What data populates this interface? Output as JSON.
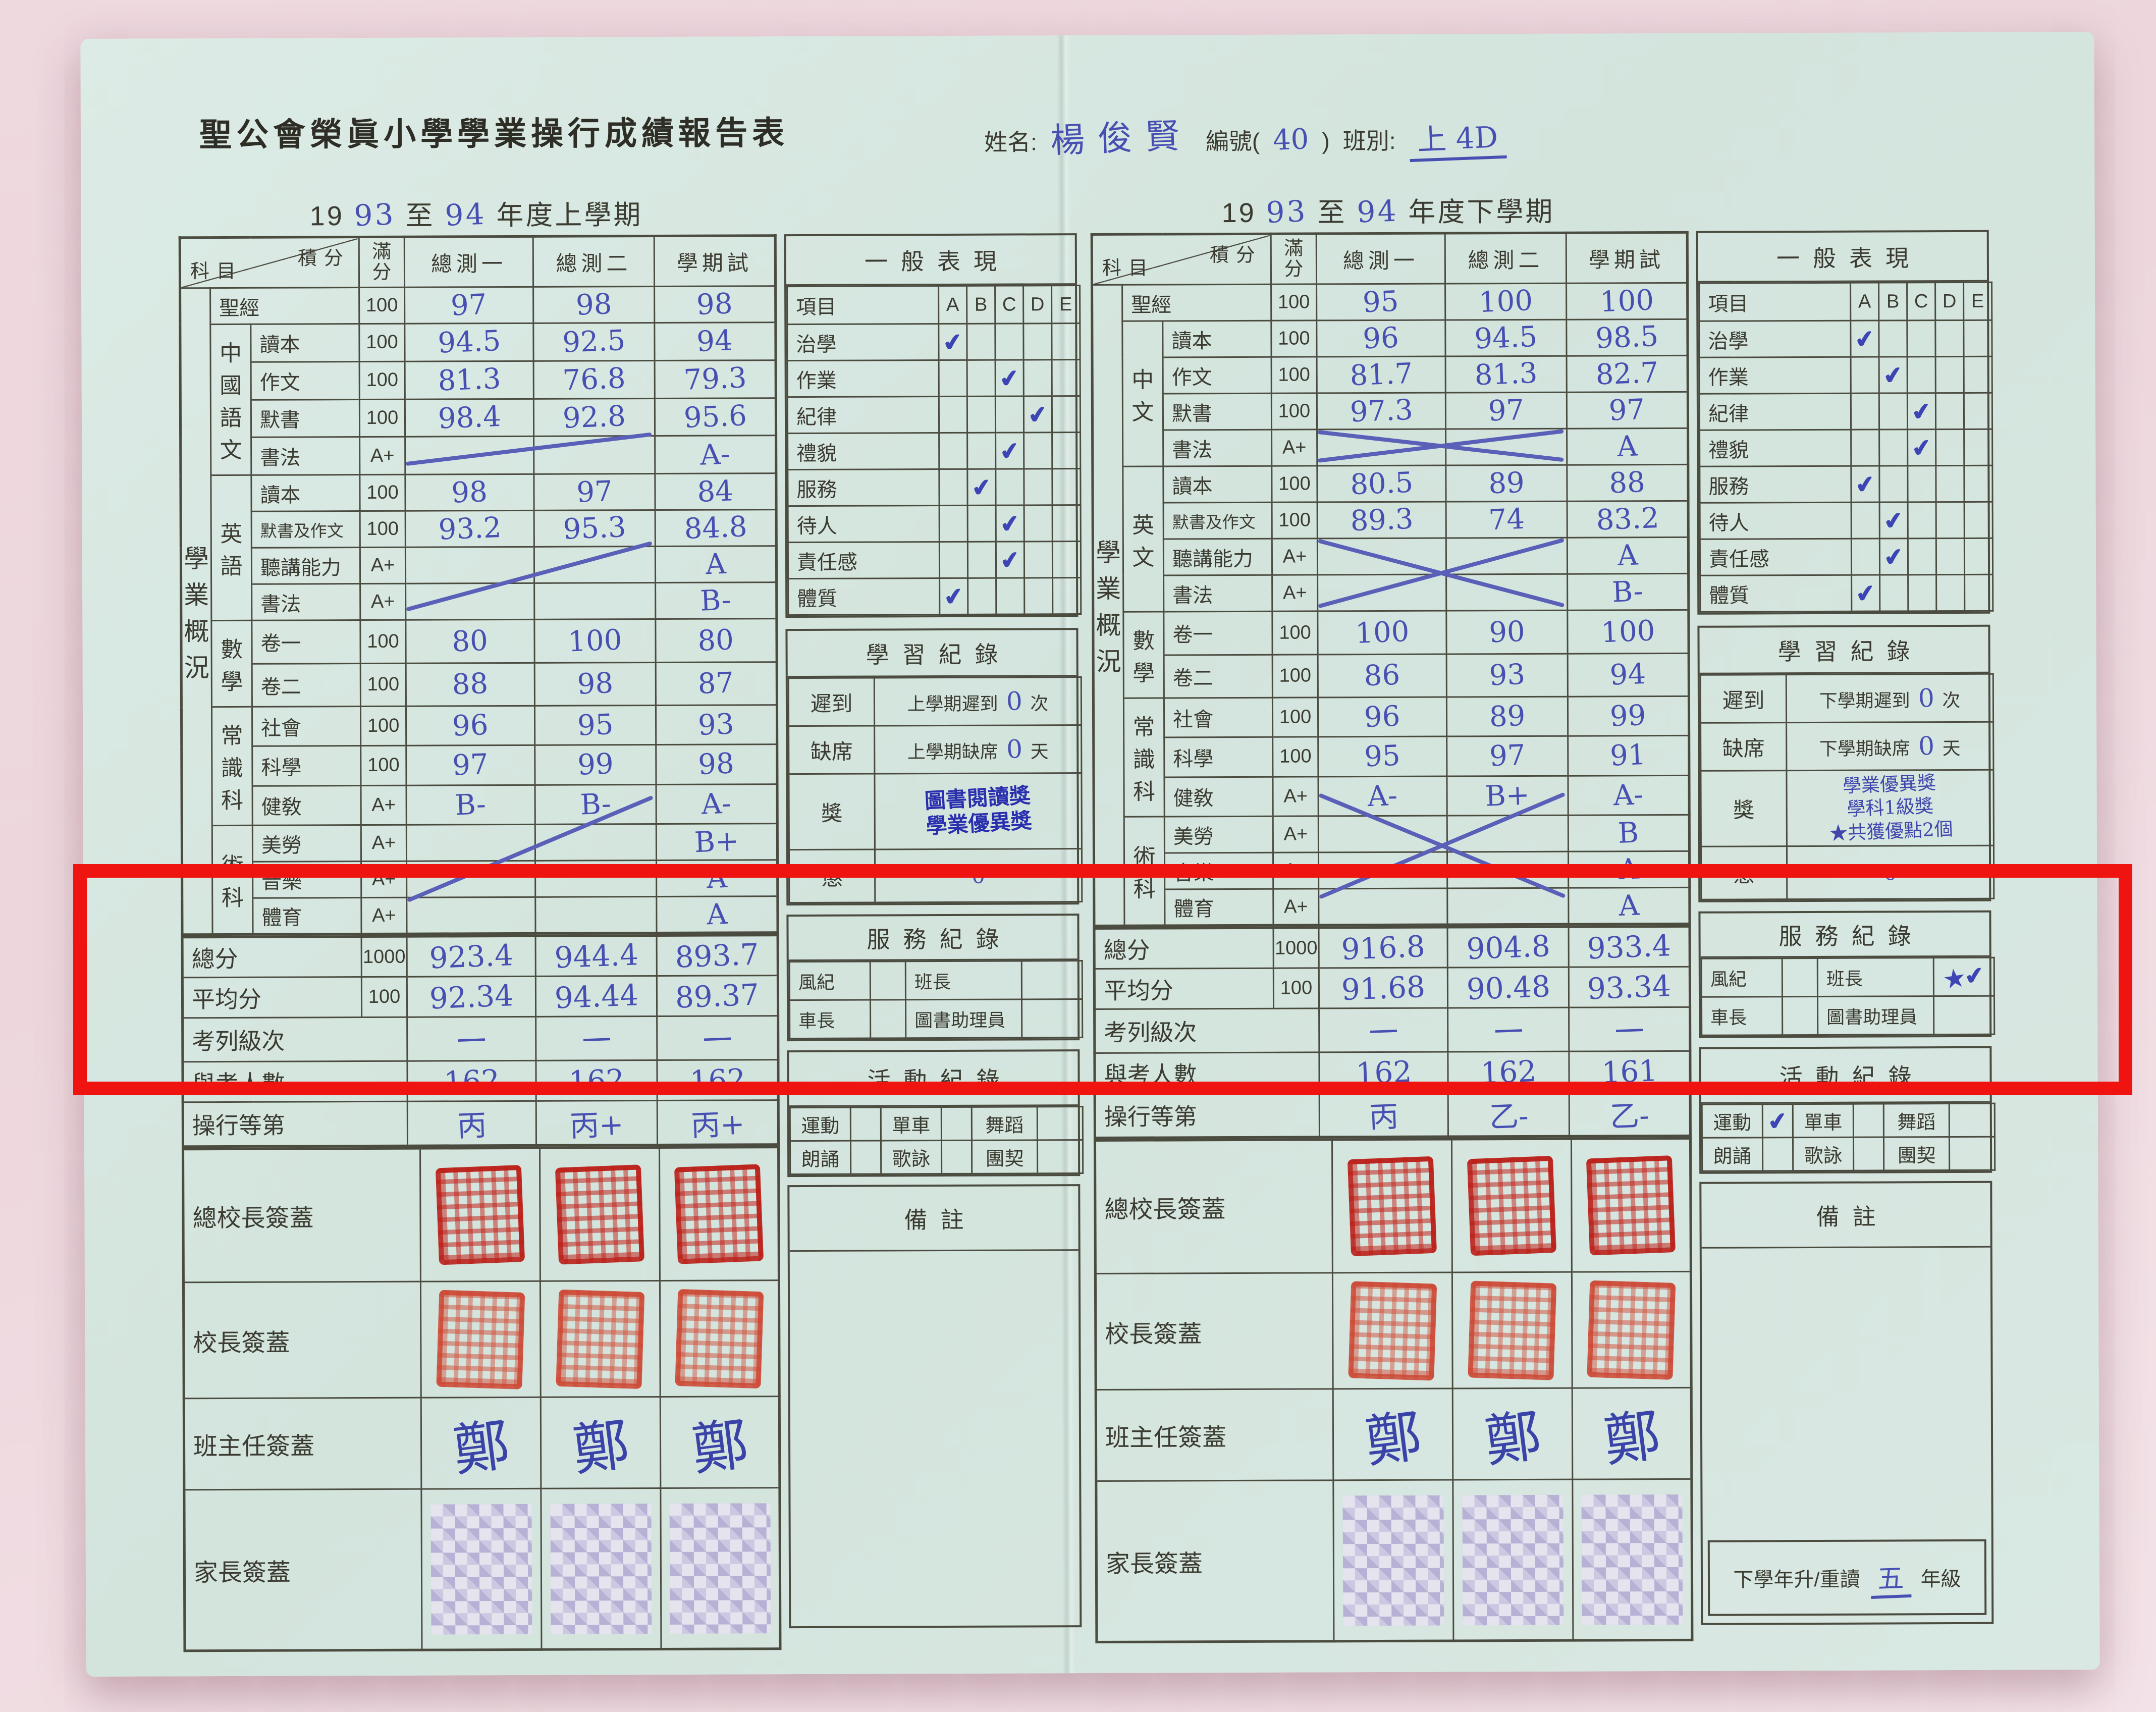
{
  "header": {
    "title": "聖公會榮眞小學學業操行成績報告表",
    "name_label": "姓名:",
    "name_value": "楊俊賢",
    "id_prefix": "編號(",
    "id_value": "40",
    "id_suffix": ")",
    "class_label": "班別:",
    "class_value": "上 4D"
  },
  "columns": {
    "subject": "科目",
    "score": "積分",
    "full": "滿分",
    "t1": "總測一",
    "t2": "總測二",
    "exam": "學期試"
  },
  "side_label": "學業概況",
  "signature_labels": [
    "總校長簽蓋",
    "校長簽蓋",
    "班主任簽蓋",
    "家長簽蓋"
  ],
  "semesters": [
    {
      "year": {
        "prefix": "19",
        "from": "93",
        "mid": "至",
        "to": "94",
        "suffix": "年度上學期"
      },
      "rows": [
        {
          "subject": "聖經",
          "full": "100",
          "t1": "97",
          "t2": "98",
          "exam": "98"
        },
        {
          "group": "中國語文",
          "gspan": 4,
          "subject": "讀本",
          "full": "100",
          "t1": "94.5",
          "t2": "92.5",
          "exam": "94"
        },
        {
          "subject": "作文",
          "full": "100",
          "t1": "81.3",
          "t2": "76.8",
          "exam": "79.3"
        },
        {
          "subject": "默書",
          "full": "100",
          "t1": "98.4",
          "t2": "92.8",
          "exam": "95.6"
        },
        {
          "subject": "書法",
          "full": "A+",
          "t1": "",
          "t2": "",
          "exam": "A-"
        },
        {
          "group": "英語",
          "gspan": 4,
          "subject": "讀本",
          "full": "100",
          "t1": "98",
          "t2": "97",
          "exam": "84"
        },
        {
          "subject": "默書及作文",
          "full": "100",
          "t1": "93.2",
          "t2": "95.3",
          "exam": "84.8"
        },
        {
          "subject": "聽講能力",
          "full": "A+",
          "t1": "",
          "t2": "",
          "exam": "A"
        },
        {
          "subject": "書法",
          "full": "A+",
          "t1": "",
          "t2": "",
          "exam": "B-"
        },
        {
          "group": "數學",
          "gspan": 2,
          "subject": "卷一",
          "full": "100",
          "t1": "80",
          "t2": "100",
          "exam": "80"
        },
        {
          "subject": "卷二",
          "full": "100",
          "t1": "88",
          "t2": "98",
          "exam": "87"
        },
        {
          "group": "常識科",
          "gspan": 3,
          "subject": "社會",
          "full": "100",
          "t1": "96",
          "t2": "95",
          "exam": "93"
        },
        {
          "subject": "科學",
          "full": "100",
          "t1": "97",
          "t2": "99",
          "exam": "98"
        },
        {
          "subject": "健敎",
          "full": "A+",
          "t1": "B-",
          "t2": "B-",
          "exam": "A-"
        },
        {
          "group": "術科",
          "gspan": 3,
          "subject": "美勞",
          "full": "A+",
          "t1": "",
          "t2": "",
          "exam": "B+"
        },
        {
          "subject": "音樂",
          "full": "A+",
          "t1": "",
          "t2": "",
          "exam": "A"
        },
        {
          "subject": "體育",
          "full": "A+",
          "t1": "",
          "t2": "",
          "exam": "A"
        }
      ],
      "marks": [
        {
          "r1": 4,
          "r2": 4,
          "type": "slash"
        },
        {
          "r1": 7,
          "r2": 8,
          "type": "slash"
        },
        {
          "r1": 14,
          "r2": 16,
          "type": "slash"
        }
      ],
      "totals": [
        {
          "label": "總分",
          "full": "1000",
          "values": [
            "923.4",
            "944.4",
            "893.7"
          ]
        },
        {
          "label": "平均分",
          "full": "100",
          "values": [
            "92.34",
            "94.44",
            "89.37"
          ]
        },
        {
          "label": "考列級次",
          "values": [
            "一",
            "一",
            "一"
          ]
        },
        {
          "label": "與考人數",
          "values": [
            "162",
            "162",
            "162"
          ]
        },
        {
          "label": "操行等第",
          "values": [
            "丙",
            "丙+",
            "丙+"
          ]
        }
      ],
      "general": {
        "title": "一般表現",
        "item_label": "項目",
        "grades": [
          "A",
          "B",
          "C",
          "D",
          "E"
        ],
        "rows": [
          {
            "label": "治學",
            "check": "A"
          },
          {
            "label": "作業",
            "check": "C"
          },
          {
            "label": "紀律",
            "check": "D"
          },
          {
            "label": "禮貌",
            "check": "C"
          },
          {
            "label": "服務",
            "check": "B"
          },
          {
            "label": "待人",
            "check": "C"
          },
          {
            "label": "責任感",
            "check": "C"
          },
          {
            "label": "體質",
            "check": "A"
          }
        ]
      },
      "study": {
        "title": "學習紀錄",
        "rows": [
          {
            "label": "遲到",
            "text": "上學期遲到",
            "value": "0",
            "unit": "次"
          },
          {
            "label": "缺席",
            "text": "上學期缺席",
            "value": "0",
            "unit": "天"
          }
        ],
        "award": {
          "label": "獎",
          "kind": "stamp",
          "lines": [
            "圖書閱讀獎",
            "學業優異獎"
          ]
        },
        "punish": {
          "label": "懲",
          "value": "0"
        }
      },
      "service": {
        "title": "服務紀錄",
        "rows": [
          [
            {
              "label": "風紀",
              "value": ""
            },
            {
              "label": "班長",
              "value": ""
            }
          ],
          [
            {
              "label": "車長",
              "value": ""
            },
            {
              "label": "圖書助理員",
              "value": ""
            }
          ]
        ]
      },
      "activity": {
        "title": "活動紀錄",
        "rows": [
          [
            {
              "label": "運動",
              "value": ""
            },
            {
              "label": "單車",
              "value": ""
            },
            {
              "label": "舞蹈",
              "value": ""
            }
          ],
          [
            {
              "label": "朗誦",
              "value": ""
            },
            {
              "label": "歌詠",
              "value": ""
            },
            {
              "label": "團契",
              "value": ""
            }
          ]
        ]
      },
      "remarks_label": "備註",
      "teacher_signature": "鄭"
    },
    {
      "year": {
        "prefix": "19",
        "from": "93",
        "mid": "至",
        "to": "94",
        "suffix": "年度下學期"
      },
      "rows": [
        {
          "subject": "聖經",
          "full": "100",
          "t1": "95",
          "t2": "100",
          "exam": "100"
        },
        {
          "group": "中文",
          "gspan": 4,
          "subject": "讀本",
          "full": "100",
          "t1": "96",
          "t2": "94.5",
          "exam": "98.5"
        },
        {
          "subject": "作文",
          "full": "100",
          "t1": "81.7",
          "t2": "81.3",
          "exam": "82.7"
        },
        {
          "subject": "默書",
          "full": "100",
          "t1": "97.3",
          "t2": "97",
          "exam": "97"
        },
        {
          "subject": "書法",
          "full": "A+",
          "t1": "",
          "t2": "",
          "exam": "A"
        },
        {
          "group": "英文",
          "gspan": 4,
          "subject": "讀本",
          "full": "100",
          "t1": "80.5",
          "t2": "89",
          "exam": "88"
        },
        {
          "subject": "默書及作文",
          "full": "100",
          "t1": "89.3",
          "t2": "74",
          "exam": "83.2"
        },
        {
          "subject": "聽講能力",
          "full": "A+",
          "t1": "",
          "t2": "",
          "exam": "A"
        },
        {
          "subject": "書法",
          "full": "A+",
          "t1": "",
          "t2": "",
          "exam": "B-"
        },
        {
          "group": "數學",
          "gspan": 2,
          "subject": "卷一",
          "full": "100",
          "t1": "100",
          "t2": "90",
          "exam": "100"
        },
        {
          "subject": "卷二",
          "full": "100",
          "t1": "86",
          "t2": "93",
          "exam": "94"
        },
        {
          "group": "常識科",
          "gspan": 3,
          "subject": "社會",
          "full": "100",
          "t1": "96",
          "t2": "89",
          "exam": "99"
        },
        {
          "subject": "科學",
          "full": "100",
          "t1": "95",
          "t2": "97",
          "exam": "91"
        },
        {
          "subject": "健敎",
          "full": "A+",
          "t1": "A-",
          "t2": "B+",
          "exam": "A-"
        },
        {
          "group": "術科",
          "gspan": 3,
          "subject": "美勞",
          "full": "A+",
          "t1": "",
          "t2": "",
          "exam": "B"
        },
        {
          "subject": "音樂",
          "full": "A+",
          "t1": "",
          "t2": "",
          "exam": "A"
        },
        {
          "subject": "體育",
          "full": "A+",
          "t1": "",
          "t2": "",
          "exam": "A"
        }
      ],
      "marks": [
        {
          "r1": 4,
          "r2": 4,
          "type": "cross"
        },
        {
          "r1": 7,
          "r2": 8,
          "type": "cross"
        },
        {
          "r1": 14,
          "r2": 16,
          "type": "cross"
        }
      ],
      "totals": [
        {
          "label": "總分",
          "full": "1000",
          "values": [
            "916.8",
            "904.8",
            "933.4"
          ]
        },
        {
          "label": "平均分",
          "full": "100",
          "values": [
            "91.68",
            "90.48",
            "93.34"
          ]
        },
        {
          "label": "考列級次",
          "values": [
            "一",
            "一",
            "一"
          ]
        },
        {
          "label": "與考人數",
          "values": [
            "162",
            "162",
            "161"
          ]
        },
        {
          "label": "操行等第",
          "values": [
            "丙",
            "乙-",
            "乙-"
          ]
        }
      ],
      "general": {
        "title": "一般表現",
        "item_label": "項目",
        "grades": [
          "A",
          "B",
          "C",
          "D",
          "E"
        ],
        "rows": [
          {
            "label": "治學",
            "check": "A"
          },
          {
            "label": "作業",
            "check": "B"
          },
          {
            "label": "紀律",
            "check": "C"
          },
          {
            "label": "禮貌",
            "check": "C"
          },
          {
            "label": "服務",
            "check": "A"
          },
          {
            "label": "待人",
            "check": "B"
          },
          {
            "label": "責任感",
            "check": "B"
          },
          {
            "label": "體質",
            "check": "A"
          }
        ]
      },
      "study": {
        "title": "學習紀錄",
        "rows": [
          {
            "label": "遲到",
            "text": "下學期遲到",
            "value": "0",
            "unit": "次"
          },
          {
            "label": "缺席",
            "text": "下學期缺席",
            "value": "0",
            "unit": "天"
          }
        ],
        "award": {
          "label": "獎",
          "kind": "hand",
          "lines": [
            "學業優異獎",
            "學科1級獎",
            "★共獲優點2個"
          ]
        },
        "punish": {
          "label": "懲",
          "value": "0"
        }
      },
      "service": {
        "title": "服務紀錄",
        "rows": [
          [
            {
              "label": "風紀",
              "value": ""
            },
            {
              "label": "班長",
              "value": "★✔"
            }
          ],
          [
            {
              "label": "車長",
              "value": ""
            },
            {
              "label": "圖書助理員",
              "value": ""
            }
          ]
        ]
      },
      "activity": {
        "title": "活動紀錄",
        "rows": [
          [
            {
              "label": "運動",
              "value": "✔"
            },
            {
              "label": "單車",
              "value": ""
            },
            {
              "label": "舞蹈",
              "value": ""
            }
          ],
          [
            {
              "label": "朗誦",
              "value": ""
            },
            {
              "label": "歌詠",
              "value": ""
            },
            {
              "label": "團契",
              "value": ""
            }
          ]
        ]
      },
      "remarks_label": "備註",
      "teacher_signature": "鄭",
      "promotion": {
        "prefix": "下學年升/重讀",
        "value": "五",
        "suffix": "年級"
      }
    }
  ]
}
